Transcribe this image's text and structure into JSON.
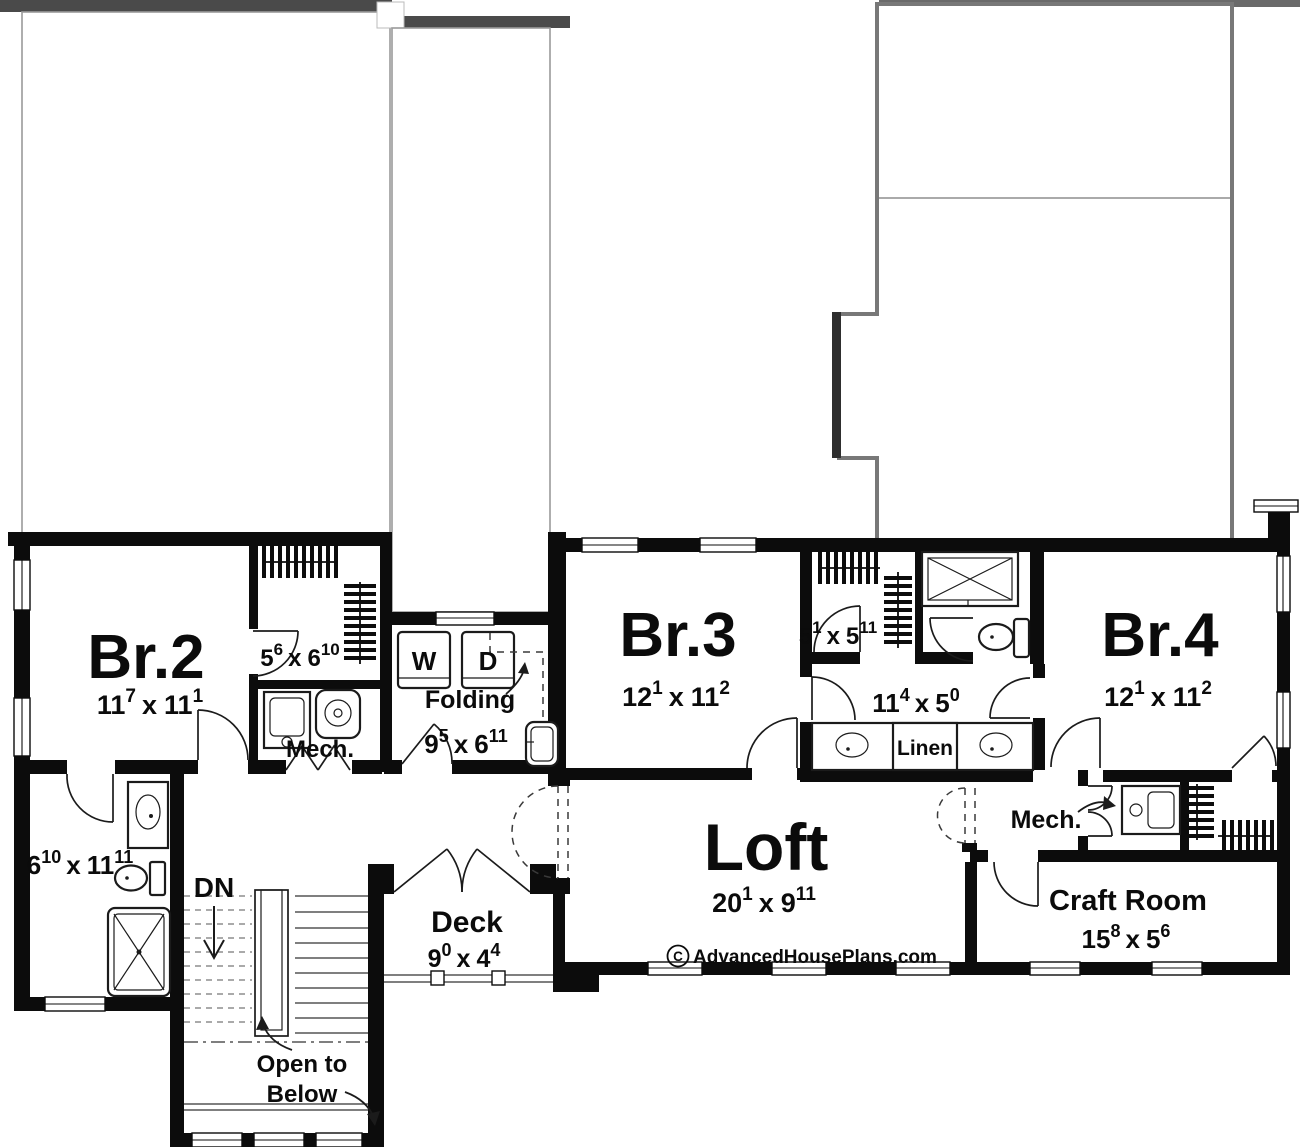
{
  "dim_sep": "x",
  "branding": {
    "symbol": "C",
    "site": "AdvancedHousePlans.com"
  },
  "stairs": {
    "dn": "DN",
    "open1": "Open to",
    "open2": "Below"
  },
  "rooms": {
    "br2": {
      "name": "Br.2",
      "d1": "11",
      "s1": "7",
      "d2": "11",
      "s2": "1"
    },
    "br2_closet": {
      "d1": "5",
      "s1": "6",
      "d2": "6",
      "s2": "10"
    },
    "mech_left": {
      "name": "Mech."
    },
    "laundry": {
      "washer": "W",
      "dryer": "D",
      "folding": "Folding",
      "d1": "9",
      "s1": "5",
      "d2": "6",
      "s2": "11"
    },
    "bath_left": {
      "d1": "6",
      "s1": "10",
      "d2": "11",
      "s2": "11"
    },
    "br3": {
      "name": "Br.3",
      "d1": "12",
      "s1": "1",
      "d2": "11",
      "s2": "2"
    },
    "br3_closet": {
      "d1": "5",
      "s1": "1",
      "d2": "5",
      "s2": "11"
    },
    "bath_main": {
      "d1": "11",
      "s1": "4",
      "d2": "5",
      "s2": "0",
      "linen": "Linen"
    },
    "br4": {
      "name": "Br.4",
      "d1": "12",
      "s1": "1",
      "d2": "11",
      "s2": "2"
    },
    "loft": {
      "name": "Loft",
      "d1": "20",
      "s1": "1",
      "d2": "9",
      "s2": "11"
    },
    "deck": {
      "name": "Deck",
      "d1": "9",
      "s1": "0",
      "d2": "4",
      "s2": "4"
    },
    "craft": {
      "name": "Craft Room",
      "d1": "15",
      "s1": "8",
      "d2": "5",
      "s2": "6"
    },
    "mech_right": {
      "name": "Mech."
    }
  }
}
